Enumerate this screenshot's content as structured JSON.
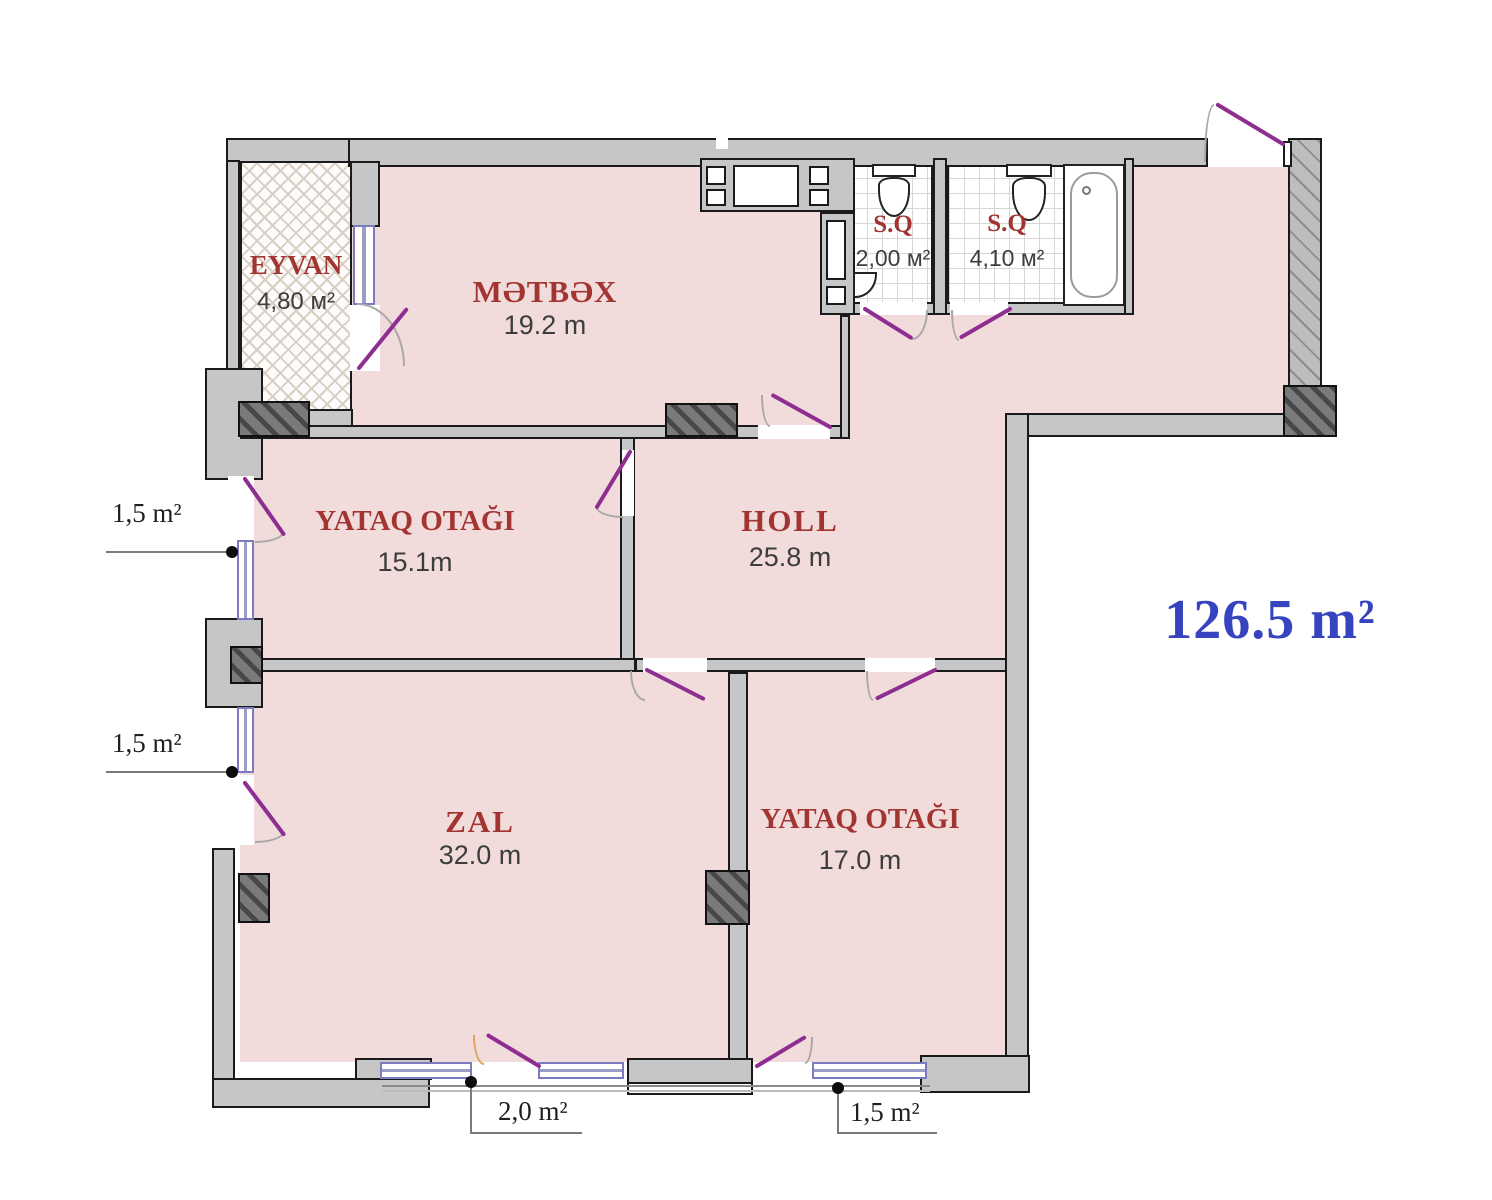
{
  "total_area": "126.5 m²",
  "rooms": {
    "eyvan": {
      "name": "EYVAN",
      "area": "4,80 м²"
    },
    "metbex": {
      "name": "MƏTBƏX",
      "area": "19.2 m"
    },
    "sq1": {
      "name": "S.Q",
      "area": "2,00 м²"
    },
    "sq2": {
      "name": "S.Q",
      "area": "4,10 м²"
    },
    "yataq1": {
      "name": "YATAQ OTAĞI",
      "area": "15.1m"
    },
    "holl": {
      "name": "HOLL",
      "area": "25.8 m"
    },
    "zal": {
      "name": "ZAL",
      "area": "32.0 m"
    },
    "yataq2": {
      "name": "YATAQ OTAĞI",
      "area": "17.0 m"
    }
  },
  "annotations": {
    "left_upper_window": "1,5 m²",
    "left_lower_window": "1,5 m²",
    "bottom_balcony_door": "2,0 m²",
    "bottom_right_window": "1,5 m²"
  },
  "colors": {
    "floor_pink": "#f1dcdb",
    "wall_gray": "#c6c6c6",
    "room_label_red": "#a23431",
    "door_purple": "#8e2e90",
    "window_blue": "#7b7bc0",
    "total_blue": "#3644c0"
  }
}
